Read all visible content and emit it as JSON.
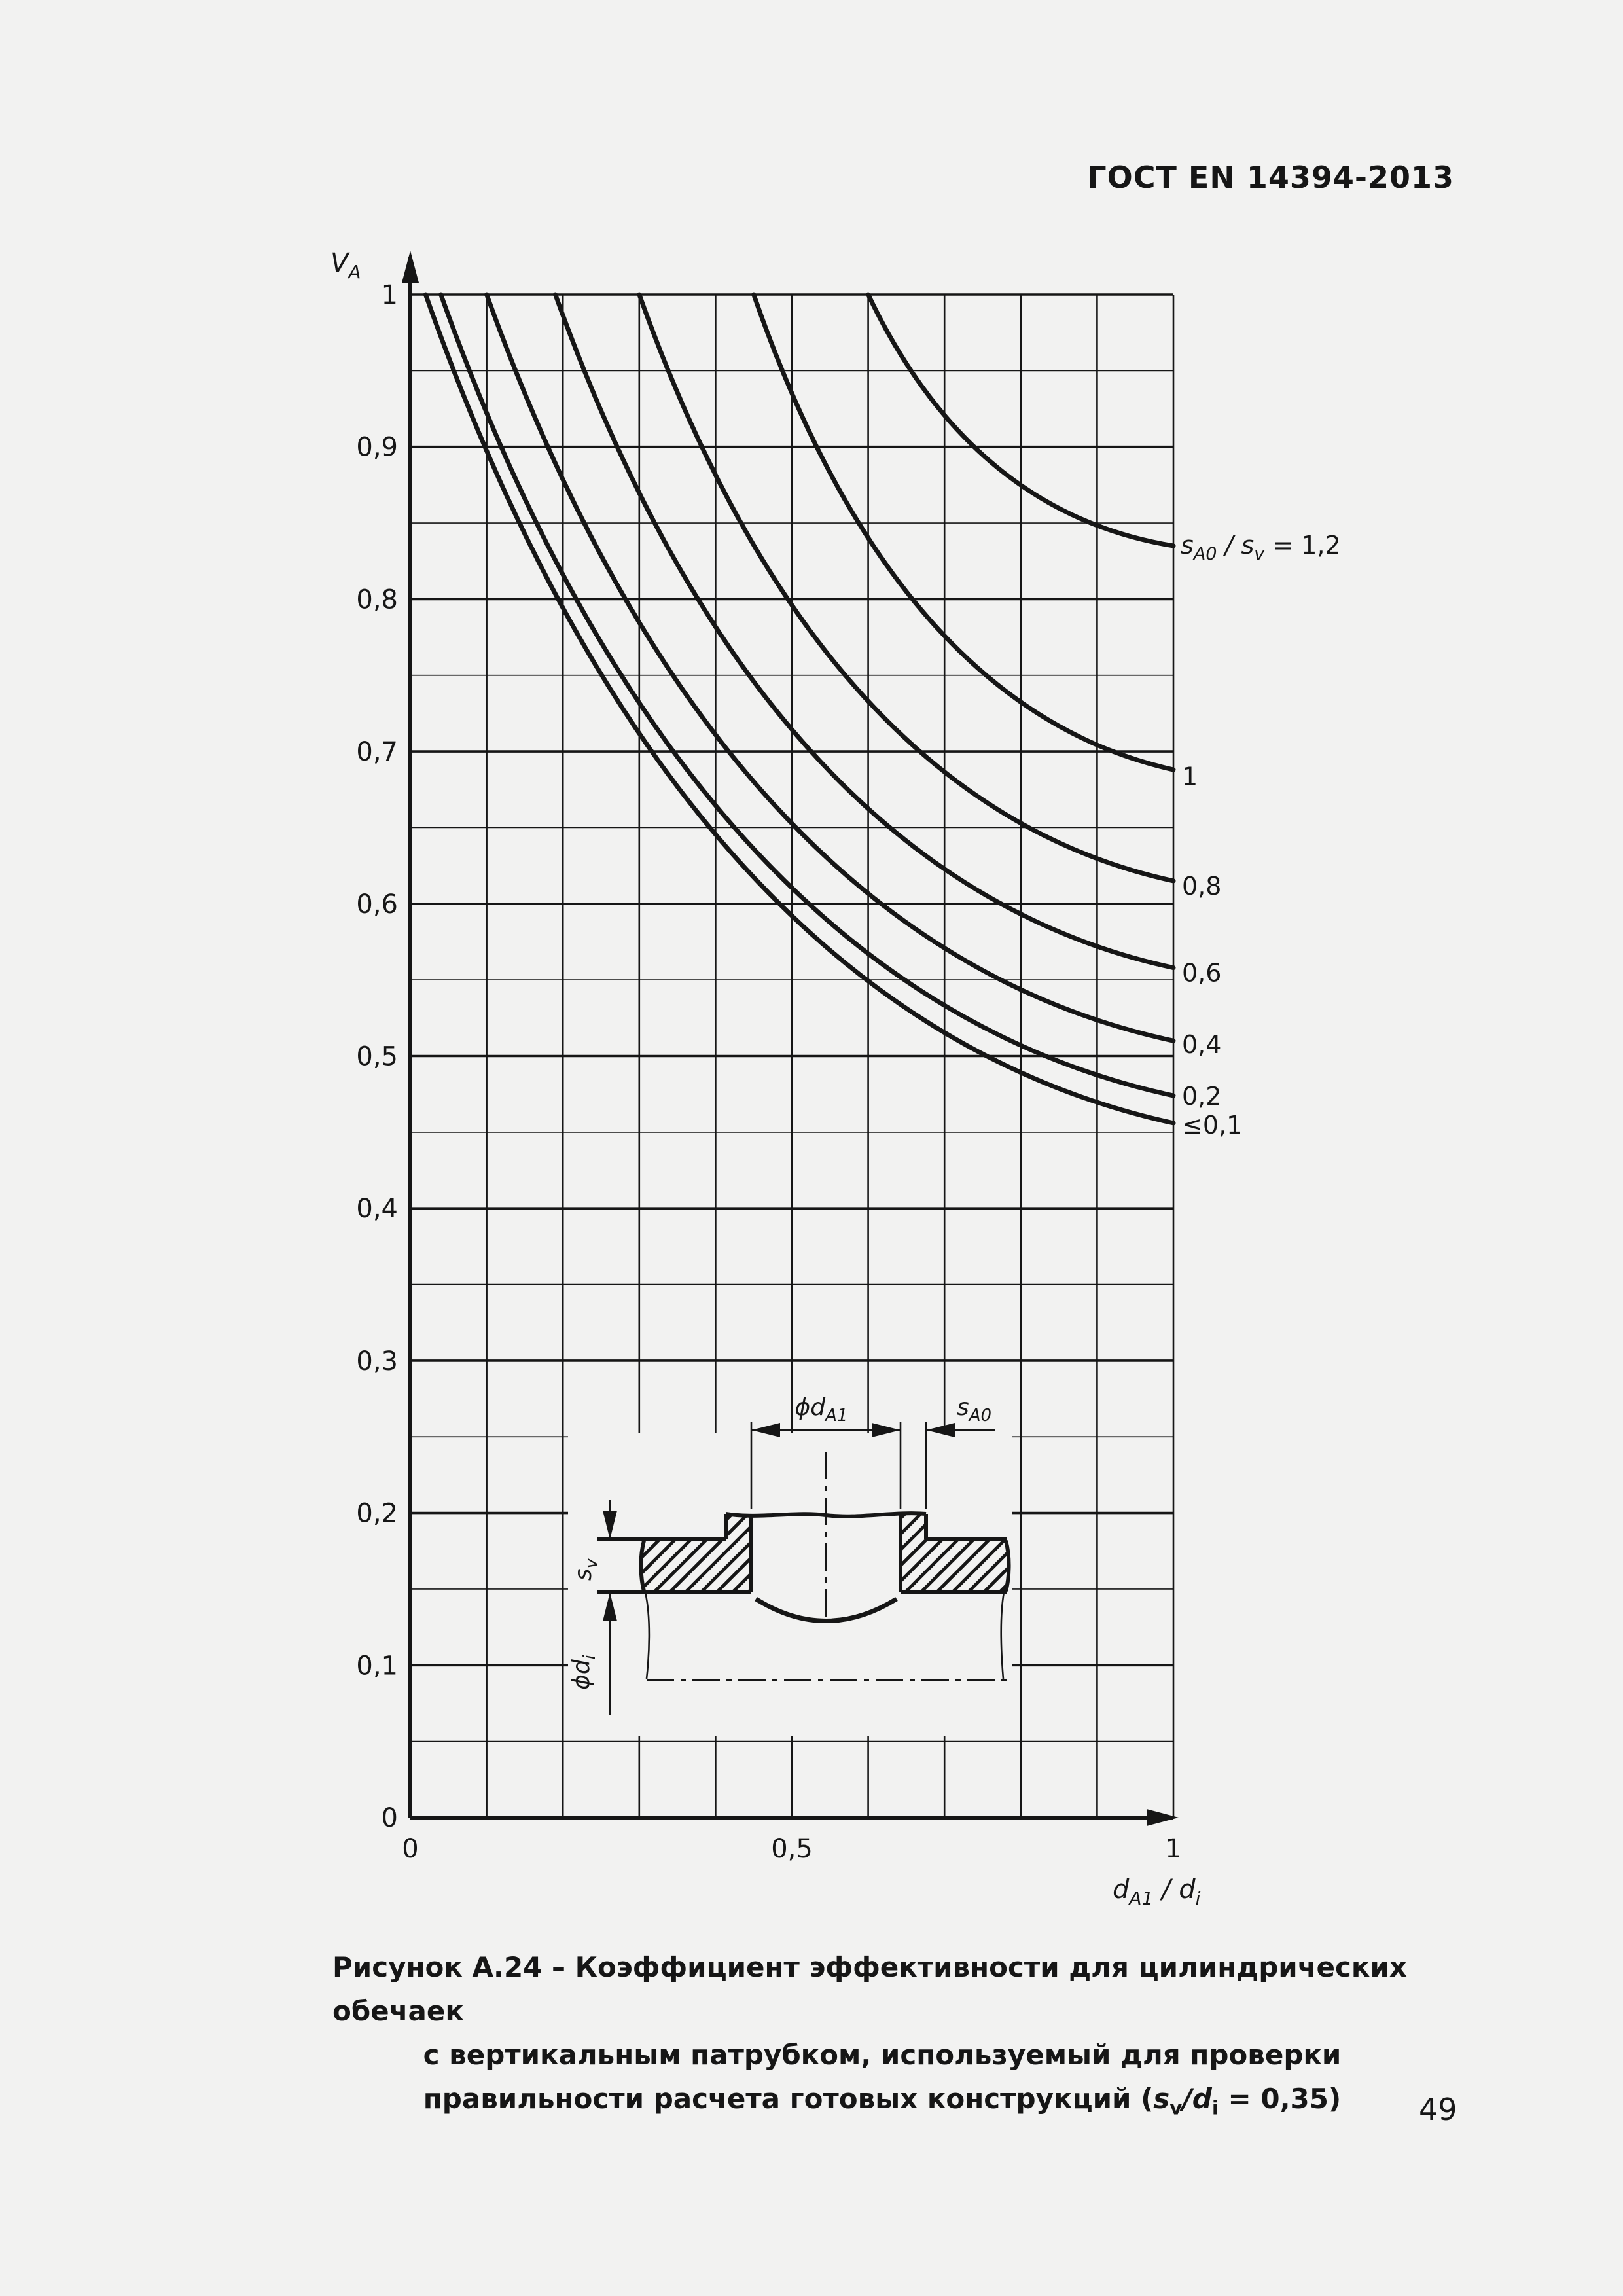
{
  "page": {
    "header": "ГОСТ EN 14394-2013",
    "page_number": "49"
  },
  "chart_data": {
    "type": "line",
    "title": "Рисунок А.24",
    "x_axis": {
      "label_parts": {
        "v1": "d",
        "s1": "A1",
        "mid": " / ",
        "v2": "d",
        "s2": "i"
      },
      "range": [
        0,
        1
      ],
      "ticks": [
        {
          "x": 0,
          "label": "0"
        },
        {
          "x": 0.5,
          "label": "0,5"
        },
        {
          "x": 1,
          "label": "1"
        }
      ]
    },
    "y_axis": {
      "label_parts": {
        "v": "V",
        "s": "A"
      },
      "range": [
        0,
        1
      ],
      "ticks": [
        {
          "v": 1.0,
          "label": "1"
        },
        {
          "v": 0.9,
          "label": "0,9"
        },
        {
          "v": 0.8,
          "label": "0,8"
        },
        {
          "v": 0.7,
          "label": "0,7"
        },
        {
          "v": 0.6,
          "label": "0,6"
        },
        {
          "v": 0.5,
          "label": "0,5"
        },
        {
          "v": 0.4,
          "label": "0,4"
        },
        {
          "v": 0.3,
          "label": "0,3"
        },
        {
          "v": 0.2,
          "label": "0,2"
        },
        {
          "v": 0.1,
          "label": "0,1"
        },
        {
          "v": 0.0,
          "label": "0"
        }
      ]
    },
    "grid": {
      "x_step": 0.1,
      "y_minor_step": 0.05,
      "y_major_step": 0.1,
      "grid_on": true
    },
    "cap_v": 1.0,
    "series": [
      {
        "name": "sA0/sv = 1,2",
        "label_parts": {
          "v1": "s",
          "s1": "A0",
          "p1": " / ",
          "v2": "s",
          "s2": "v",
          "p2": " = 1,2"
        },
        "depart_x": 0.6,
        "end_v": 0.835,
        "label_v": 0.832
      },
      {
        "name": "sA0/sv = 1",
        "label": "1",
        "depart_x": 0.45,
        "end_v": 0.688,
        "label_v": 0.684
      },
      {
        "name": "sA0/sv = 0,8",
        "label": "0,8",
        "depart_x": 0.3,
        "end_v": 0.615,
        "label_v": 0.612
      },
      {
        "name": "sA0/sv = 0,6",
        "label": "0,6",
        "depart_x": 0.19,
        "end_v": 0.558,
        "label_v": 0.555
      },
      {
        "name": "sA0/sv = 0,4",
        "label": "0,4",
        "depart_x": 0.1,
        "end_v": 0.51,
        "label_v": 0.508
      },
      {
        "name": "sA0/sv = 0,2",
        "label": "0,2",
        "depart_x": 0.04,
        "end_v": 0.474,
        "label_v": 0.474
      },
      {
        "name": "sA0/sv <= 0,1",
        "label": "≤0,1",
        "depart_x": 0.02,
        "end_v": 0.456,
        "label_v": 0.455
      }
    ]
  },
  "inset": {
    "dim_phi_dA1": {
      "p": "ϕ",
      "v": "d",
      "s": "A1"
    },
    "dim_sA0": {
      "v": "s",
      "s": "A0"
    },
    "dim_sv": {
      "v": "s",
      "s": "v"
    },
    "dim_phi_di": {
      "p": "ϕ",
      "v": "d",
      "s": "i"
    }
  },
  "caption": {
    "prefix": "Рисунок А.24 – ",
    "line1": "Коэффициент эффективности для цилиндрических обечаек",
    "line2": "с вертикальным патрубком, используемый для проверки",
    "line3_parts": {
      "p1": "правильности расчета готовых конструкций (",
      "v1": "s",
      "s1": "v",
      "p2": "/",
      "v2": "d",
      "s2": "i",
      "p3": " = 0,35)"
    }
  }
}
